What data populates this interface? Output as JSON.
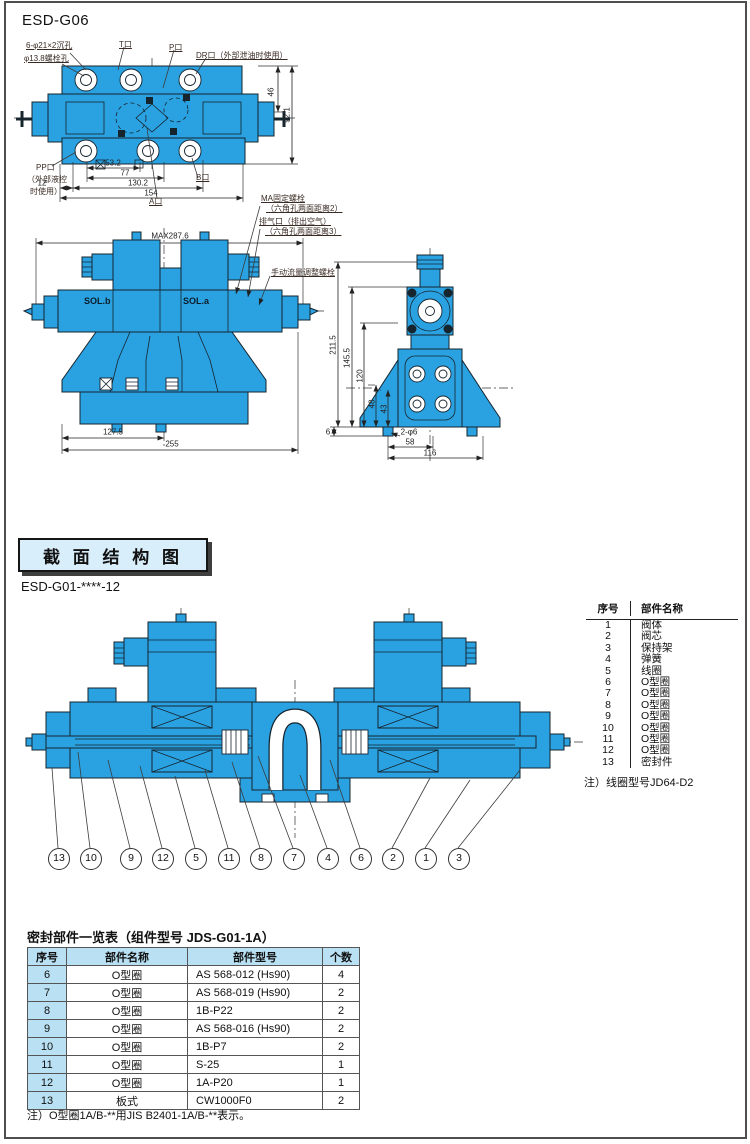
{
  "page": {
    "model_top": "ESD-G06",
    "section_model": "ESD-G01-****-12"
  },
  "top_view": {
    "labels": {
      "counterbore": "6-φ21×2沉孔",
      "bolt_hole": "φ13.8螺栓孔",
      "t_port": "T口",
      "p_port": "P口",
      "dr_port": "DR口（外部泄油时使用）",
      "pp_port": "PP口",
      "pp_port_sub1": "（外部液控",
      "pp_port_sub2": "时使用）",
      "a_port": "A口",
      "b_port": "B口"
    },
    "dims": {
      "height_upper": "46",
      "height_total": "92.1",
      "w1": "53.2",
      "w2": "77",
      "w3": "12",
      "w4": "130.2",
      "w5": "154"
    }
  },
  "front_view": {
    "labels": {
      "max_width": "MAX287.6",
      "sol_b": "SOL.b",
      "sol_a": "SOL.a",
      "ma_bolt1": "MA固定螺栓",
      "ma_bolt2": "（六角孔两面距离2）",
      "vent1": "排气口（排出空气）",
      "vent2": "（六角孔两面距离3）",
      "manual_adjust": "手动流量调整螺栓"
    },
    "dims": {
      "w_half": "127.5",
      "w_total": "255"
    }
  },
  "side_view": {
    "dims": {
      "h_total": "211.5",
      "h2": "145.5",
      "h3": "120",
      "h4": "48",
      "h5": "43",
      "foot": "6",
      "holes": "2-φ6",
      "w1": "58",
      "w2": "116"
    }
  },
  "section": {
    "header": "截 面 结 构 图",
    "callouts": [
      "13",
      "10",
      "9",
      "12",
      "5",
      "11",
      "8",
      "7",
      "4",
      "6",
      "2",
      "1",
      "3"
    ],
    "parts_table": {
      "headers": [
        "序号",
        "部件名称"
      ],
      "rows": [
        [
          "1",
          "阀体"
        ],
        [
          "2",
          "阀芯"
        ],
        [
          "3",
          "保持架"
        ],
        [
          "4",
          "弹簧"
        ],
        [
          "5",
          "线圈"
        ],
        [
          "6",
          "O型圈"
        ],
        [
          "7",
          "O型圈"
        ],
        [
          "8",
          "O型圈"
        ],
        [
          "9",
          "O型圈"
        ],
        [
          "10",
          "O型圈"
        ],
        [
          "11",
          "O型圈"
        ],
        [
          "12",
          "O型圈"
        ],
        [
          "13",
          "密封件"
        ]
      ],
      "note": "注）线圈型号JD64-D2"
    }
  },
  "seal_table": {
    "title": "密封部件一览表（组件型号 JDS-G01-1A）",
    "headers": [
      "序号",
      "部件名称",
      "部件型号",
      "个数"
    ],
    "rows": [
      [
        "6",
        "O型圈",
        "AS 568-012 (Hs90)",
        "4"
      ],
      [
        "7",
        "O型圈",
        "AS 568-019 (Hs90)",
        "2"
      ],
      [
        "8",
        "O型圈",
        "1B-P22",
        "2"
      ],
      [
        "9",
        "O型圈",
        "AS 568-016 (Hs90)",
        "2"
      ],
      [
        "10",
        "O型圈",
        "1B-P7",
        "2"
      ],
      [
        "11",
        "O型圈",
        "S-25",
        "1"
      ],
      [
        "12",
        "O型圈",
        "1A-P20",
        "1"
      ],
      [
        "13",
        "板式",
        "CW1000F0",
        "2"
      ]
    ],
    "note": "注）O型圈1A/B-**用JIS B2401-1A/B-**表示。"
  },
  "colors": {
    "drawing_blue": "#2aa2e2",
    "table_header_bg": "#b9e1f3",
    "section_header_bg": "#d9eefb"
  }
}
